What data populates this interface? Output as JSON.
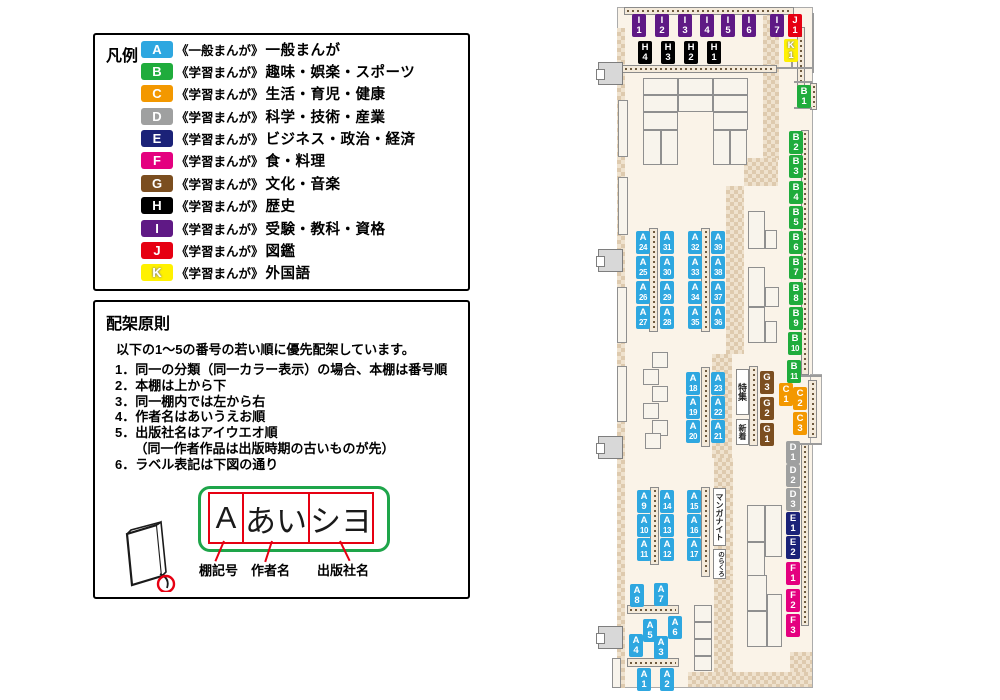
{
  "legend": {
    "title": "凡例",
    "rows": [
      {
        "code": "A",
        "series": "《一般まんが》",
        "label": "一般まんが"
      },
      {
        "code": "B",
        "series": "《学習まんが》",
        "label": "趣味・娯楽・スポーツ"
      },
      {
        "code": "C",
        "series": "《学習まんが》",
        "label": "生活・育児・健康"
      },
      {
        "code": "D",
        "series": "《学習まんが》",
        "label": "科学・技術・産業"
      },
      {
        "code": "E",
        "series": "《学習まんが》",
        "label": "ビジネス・政治・経済"
      },
      {
        "code": "F",
        "series": "《学習まんが》",
        "label": "食・料理"
      },
      {
        "code": "G",
        "series": "《学習まんが》",
        "label": "文化・音楽"
      },
      {
        "code": "H",
        "series": "《学習まんが》",
        "label": "歴史"
      },
      {
        "code": "I",
        "series": "《学習まんが》",
        "label": "受験・教科・資格"
      },
      {
        "code": "J",
        "series": "《学習まんが》",
        "label": "図鑑"
      },
      {
        "code": "K",
        "series": "《学習まんが》",
        "label": "外国語"
      }
    ]
  },
  "principles": {
    "title": "配架原則",
    "intro": "以下の1～5の番号の若い順に優先配架しています。",
    "items": [
      "1．同一の分類（同一カラー表示）の場合、本棚は番号順",
      "2．本棚は上から下",
      "3．同一棚内では左から右",
      "4．作者名はあいうえお順",
      "5．出版社名はアイウエオ順",
      "　　（同一作者作品は出版時期の古いものが先）",
      "6．ラベル表記は下図の通り"
    ],
    "label_example": {
      "shelf": "A",
      "author": "あい",
      "publisher": "シヨ"
    },
    "callouts": [
      "棚記号",
      "作者名",
      "出版社名"
    ]
  },
  "map": {
    "colors": {
      "A": "#2EA7E0",
      "B": "#1FAC3C",
      "C": "#F39800",
      "D": "#9FA0A0",
      "E": "#1B2278",
      "F": "#E4007F",
      "G": "#7B4E20",
      "H": "#000000",
      "I": "#5F1985",
      "J": "#E60012",
      "K": "#FFF100"
    },
    "area_labels": [
      {
        "text": "特集",
        "x": 736,
        "y": 369,
        "w": 13,
        "h": 46,
        "fs": 9
      },
      {
        "text": "新着",
        "x": 736,
        "y": 419,
        "w": 13,
        "h": 26,
        "fs": 8
      },
      {
        "text": "マンガナイト",
        "x": 713,
        "y": 488,
        "w": 13,
        "h": 58,
        "fs": 8
      },
      {
        "text": "のらくろ",
        "x": 713,
        "y": 549,
        "w": 13,
        "h": 30,
        "fs": 6.5
      }
    ],
    "shelf_labels": [
      {
        "id": "I1",
        "x": 632,
        "y": 14
      },
      {
        "id": "I2",
        "x": 655,
        "y": 14
      },
      {
        "id": "I3",
        "x": 678,
        "y": 14
      },
      {
        "id": "I4",
        "x": 700,
        "y": 14
      },
      {
        "id": "I5",
        "x": 721,
        "y": 14
      },
      {
        "id": "I6",
        "x": 742,
        "y": 14
      },
      {
        "id": "I7",
        "x": 770,
        "y": 14
      },
      {
        "id": "J1",
        "x": 788,
        "y": 14
      },
      {
        "id": "K1",
        "x": 784,
        "y": 39
      },
      {
        "id": "H4",
        "x": 638,
        "y": 41
      },
      {
        "id": "H3",
        "x": 661,
        "y": 41
      },
      {
        "id": "H2",
        "x": 684,
        "y": 41
      },
      {
        "id": "H1",
        "x": 707,
        "y": 41
      },
      {
        "id": "B1",
        "x": 797,
        "y": 85
      },
      {
        "id": "B2",
        "x": 789,
        "y": 131
      },
      {
        "id": "B3",
        "x": 789,
        "y": 155
      },
      {
        "id": "B4",
        "x": 789,
        "y": 181
      },
      {
        "id": "B5",
        "x": 789,
        "y": 206
      },
      {
        "id": "B6",
        "x": 789,
        "y": 231
      },
      {
        "id": "B7",
        "x": 789,
        "y": 256
      },
      {
        "id": "B8",
        "x": 789,
        "y": 282
      },
      {
        "id": "B9",
        "x": 789,
        "y": 307
      },
      {
        "id": "B10",
        "x": 788,
        "y": 332
      },
      {
        "id": "B11",
        "x": 787,
        "y": 360
      },
      {
        "id": "C1",
        "x": 779,
        "y": 383
      },
      {
        "id": "C2",
        "x": 793,
        "y": 387
      },
      {
        "id": "C3",
        "x": 793,
        "y": 412
      },
      {
        "id": "D1",
        "x": 786,
        "y": 441
      },
      {
        "id": "D2",
        "x": 786,
        "y": 464
      },
      {
        "id": "D3",
        "x": 786,
        "y": 488
      },
      {
        "id": "E1",
        "x": 786,
        "y": 512
      },
      {
        "id": "E2",
        "x": 786,
        "y": 536
      },
      {
        "id": "F1",
        "x": 786,
        "y": 562
      },
      {
        "id": "F2",
        "x": 786,
        "y": 589
      },
      {
        "id": "F3",
        "x": 786,
        "y": 614
      },
      {
        "id": "G3",
        "x": 760,
        "y": 371
      },
      {
        "id": "G2",
        "x": 760,
        "y": 397
      },
      {
        "id": "G1",
        "x": 760,
        "y": 423
      },
      {
        "id": "A24",
        "x": 636,
        "y": 231
      },
      {
        "id": "A31",
        "x": 660,
        "y": 231
      },
      {
        "id": "A32",
        "x": 688,
        "y": 231
      },
      {
        "id": "A39",
        "x": 711,
        "y": 231
      },
      {
        "id": "A25",
        "x": 636,
        "y": 256
      },
      {
        "id": "A30",
        "x": 660,
        "y": 256
      },
      {
        "id": "A33",
        "x": 688,
        "y": 256
      },
      {
        "id": "A38",
        "x": 711,
        "y": 256
      },
      {
        "id": "A26",
        "x": 636,
        "y": 281
      },
      {
        "id": "A29",
        "x": 660,
        "y": 281
      },
      {
        "id": "A34",
        "x": 688,
        "y": 281
      },
      {
        "id": "A37",
        "x": 711,
        "y": 281
      },
      {
        "id": "A27",
        "x": 636,
        "y": 306
      },
      {
        "id": "A28",
        "x": 660,
        "y": 306
      },
      {
        "id": "A35",
        "x": 688,
        "y": 306
      },
      {
        "id": "A36",
        "x": 711,
        "y": 306
      },
      {
        "id": "A18",
        "x": 686,
        "y": 372
      },
      {
        "id": "A23",
        "x": 711,
        "y": 372
      },
      {
        "id": "A19",
        "x": 686,
        "y": 396
      },
      {
        "id": "A22",
        "x": 711,
        "y": 396
      },
      {
        "id": "A20",
        "x": 686,
        "y": 420
      },
      {
        "id": "A21",
        "x": 711,
        "y": 420
      },
      {
        "id": "A9",
        "x": 637,
        "y": 490
      },
      {
        "id": "A14",
        "x": 660,
        "y": 490
      },
      {
        "id": "A15",
        "x": 687,
        "y": 490
      },
      {
        "id": "A10",
        "x": 637,
        "y": 514
      },
      {
        "id": "A13",
        "x": 660,
        "y": 514
      },
      {
        "id": "A16",
        "x": 687,
        "y": 514
      },
      {
        "id": "A11",
        "x": 637,
        "y": 538
      },
      {
        "id": "A12",
        "x": 660,
        "y": 538
      },
      {
        "id": "A17",
        "x": 687,
        "y": 538
      },
      {
        "id": "A8",
        "x": 630,
        "y": 584
      },
      {
        "id": "A7",
        "x": 654,
        "y": 583
      },
      {
        "id": "A5",
        "x": 643,
        "y": 619
      },
      {
        "id": "A6",
        "x": 668,
        "y": 616
      },
      {
        "id": "A4",
        "x": 629,
        "y": 634
      },
      {
        "id": "A3",
        "x": 654,
        "y": 636
      },
      {
        "id": "A1",
        "x": 637,
        "y": 668
      },
      {
        "id": "A2",
        "x": 660,
        "y": 668
      }
    ]
  }
}
